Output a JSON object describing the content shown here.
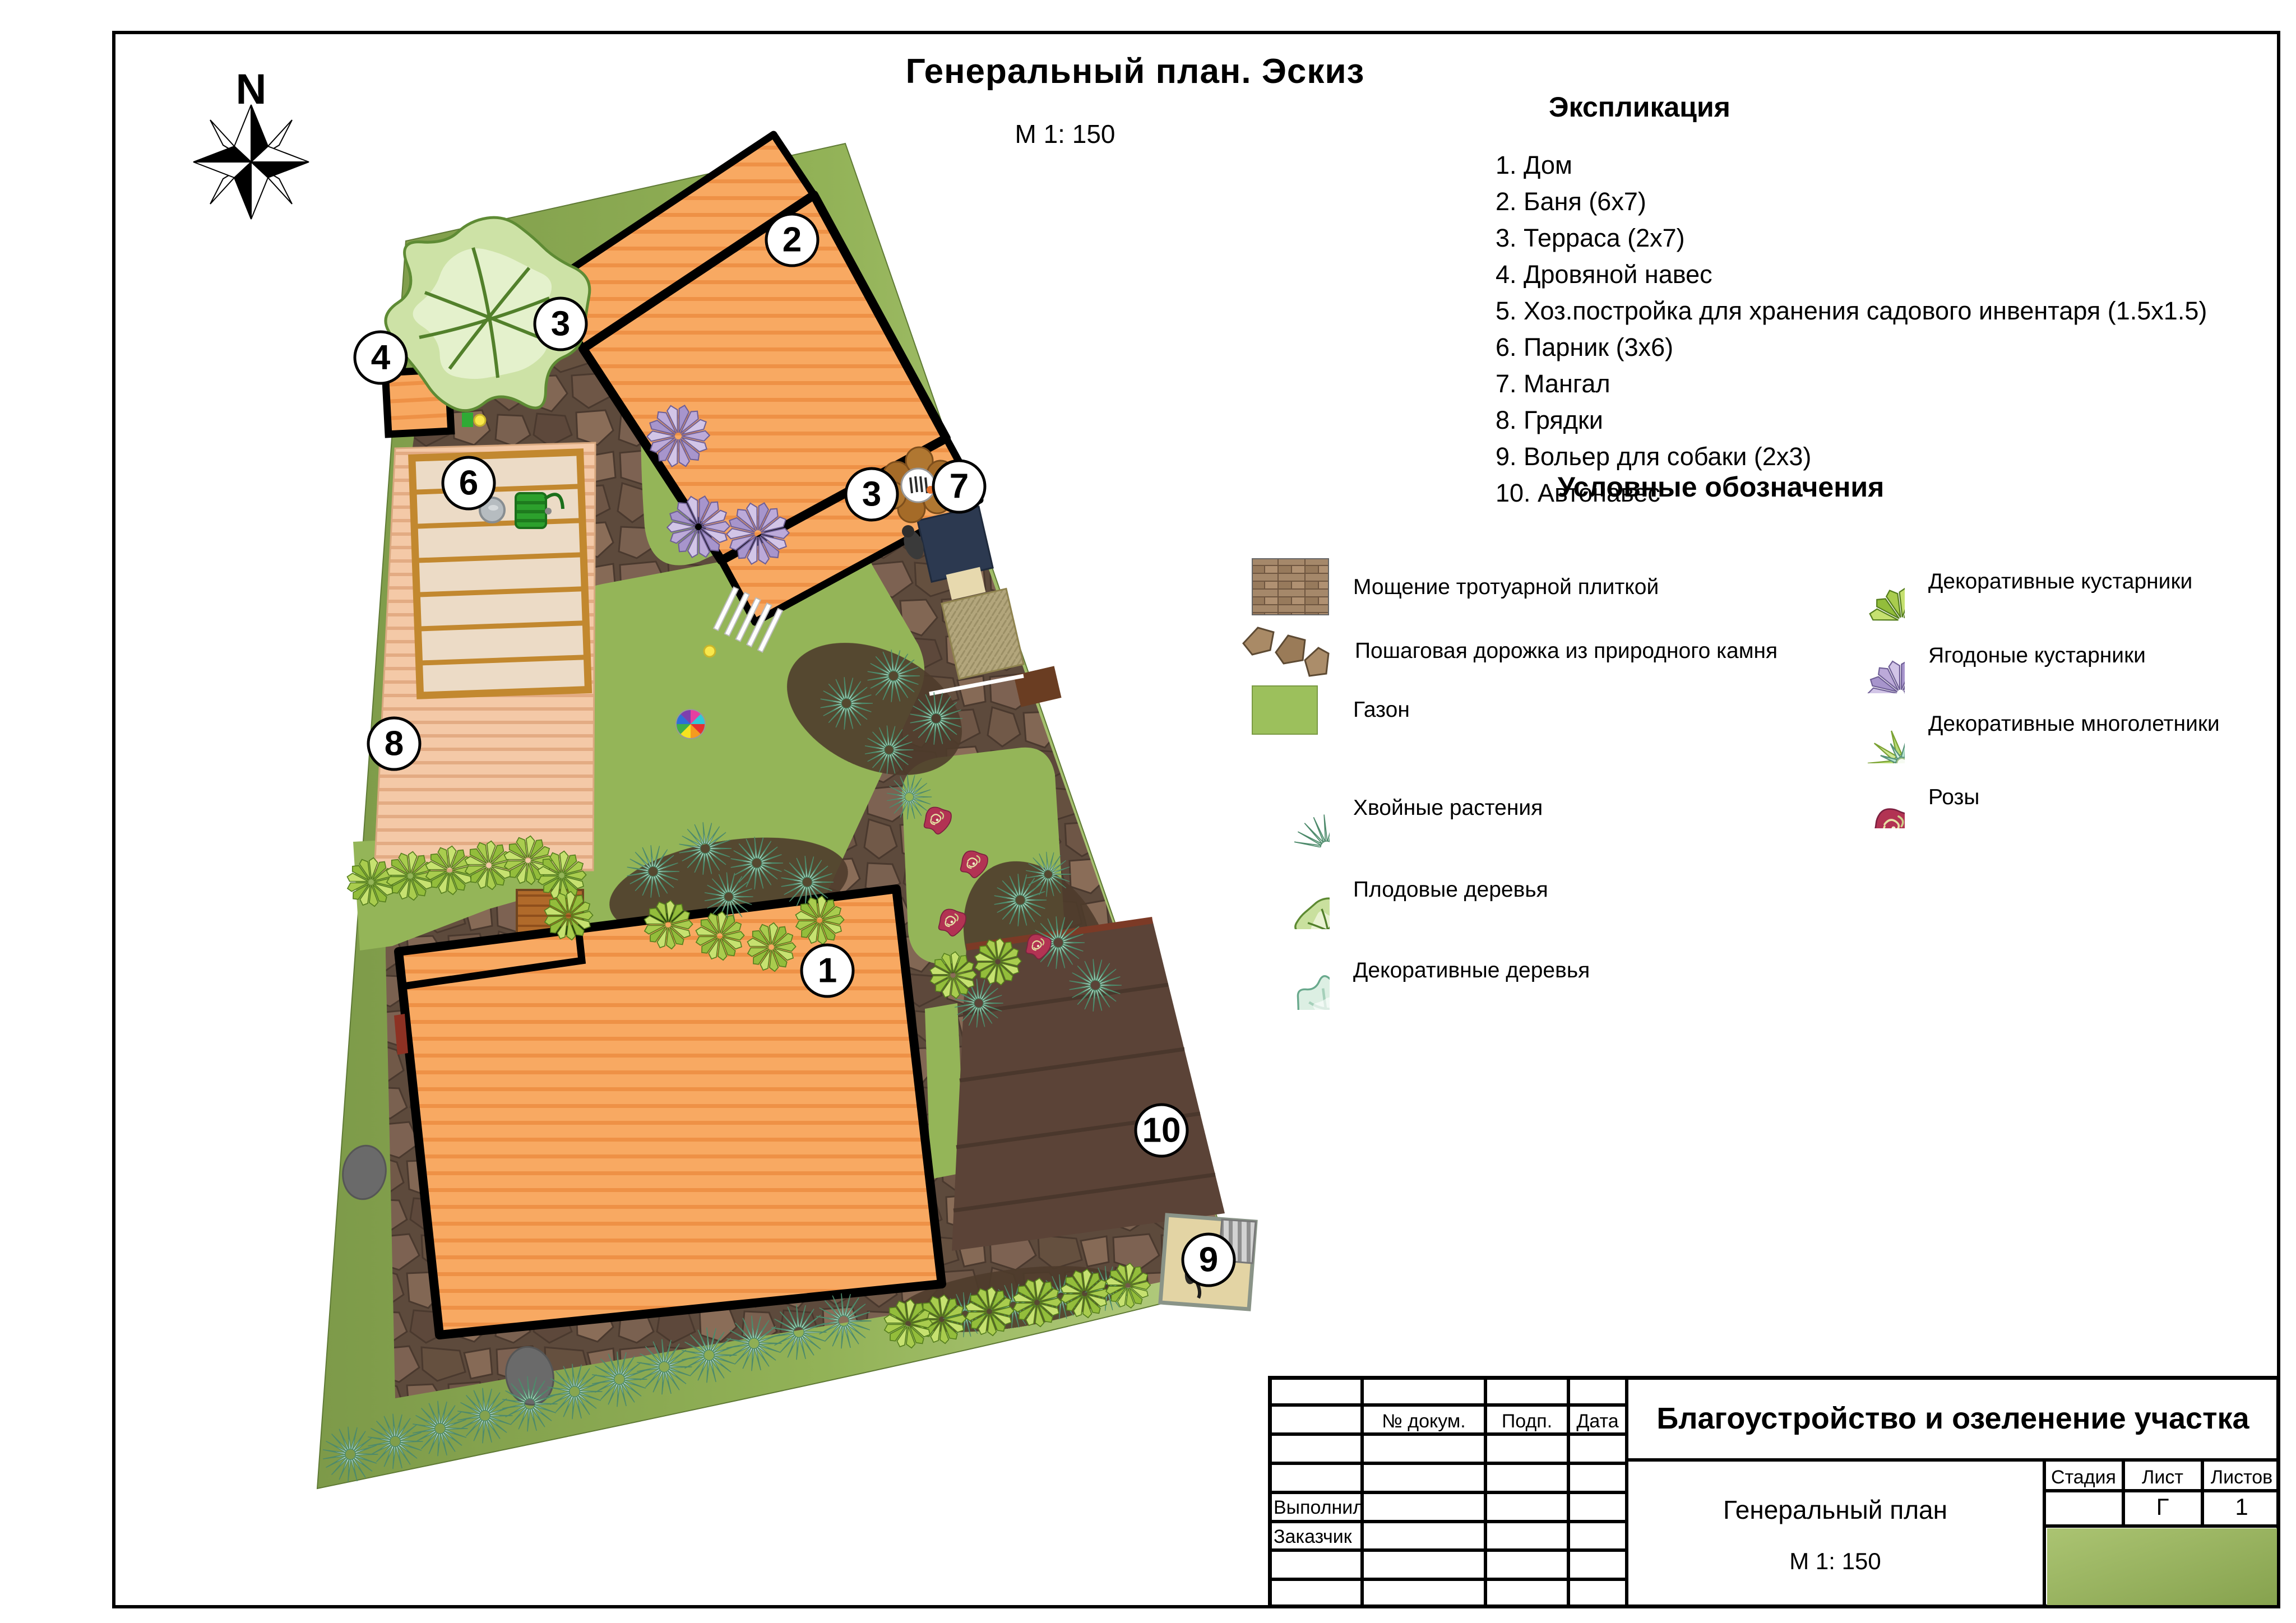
{
  "page": {
    "title": "Генеральный план. Эскиз",
    "scale": "М 1: 150"
  },
  "compass": {
    "north": "N"
  },
  "explication": {
    "heading": "Экспликация",
    "items": [
      "1. Дом",
      "2. Баня (6х7)",
      "3. Терраса (2х7)",
      "4. Дровяной навес",
      "5. Хоз.постройка для хранения садового инвентаря (1.5х1.5)",
      "6. Парник (3х6)",
      "7. Мангал",
      "8. Грядки",
      "9. Вольер для собаки (2х3)",
      "10. Автонавес"
    ]
  },
  "legend": {
    "heading": "Условные обозначения",
    "left": [
      {
        "icon": "paving-swatch-icon",
        "label": "Мощение тротуарной плиткой"
      },
      {
        "icon": "stepping-stones-icon",
        "label": "Пошаговая дорожка из природного камня"
      },
      {
        "icon": "lawn-swatch-icon",
        "label": "Газон"
      },
      {
        "icon": "conifer-icon",
        "label": "Хвойные растения"
      },
      {
        "icon": "fruit-tree-icon",
        "label": "Плодовые деревья"
      },
      {
        "icon": "decorative-tree-icon",
        "label": "Декоративные деревья"
      }
    ],
    "right": [
      {
        "icon": "decorative-shrub-icon",
        "label": "Декоративные кустарники"
      },
      {
        "icon": "berry-shrub-icon",
        "label": "Ягодоные кустарники"
      },
      {
        "icon": "perennial-icon",
        "label": "Декоративные многолетники"
      },
      {
        "icon": "rose-icon",
        "label": "Розы"
      }
    ]
  },
  "plan": {
    "labels": [
      "1",
      "2",
      "3",
      "3",
      "4",
      "6",
      "7",
      "8",
      "9",
      "10"
    ]
  },
  "title_block": {
    "doc_col": "№ докум.",
    "sign_col": "Подп.",
    "date_col": "Дата",
    "performed_label": "Выполнил",
    "customer_label": "Заказчик",
    "project_title": "Благоустройство и озеленение участка",
    "drawing_title": "Генеральный план",
    "drawing_scale": "М 1: 150",
    "stage_label": "Стадия",
    "sheet_label": "Лист",
    "sheets_label": "Листов",
    "stage_value": "",
    "sheet_value": "Г",
    "sheets_value": "1"
  },
  "colors": {
    "lawn": "#92b257",
    "paving": "#6b5444",
    "building": "#f8a962",
    "carport": "#5b4337",
    "accent_green": "#9bbf65"
  }
}
